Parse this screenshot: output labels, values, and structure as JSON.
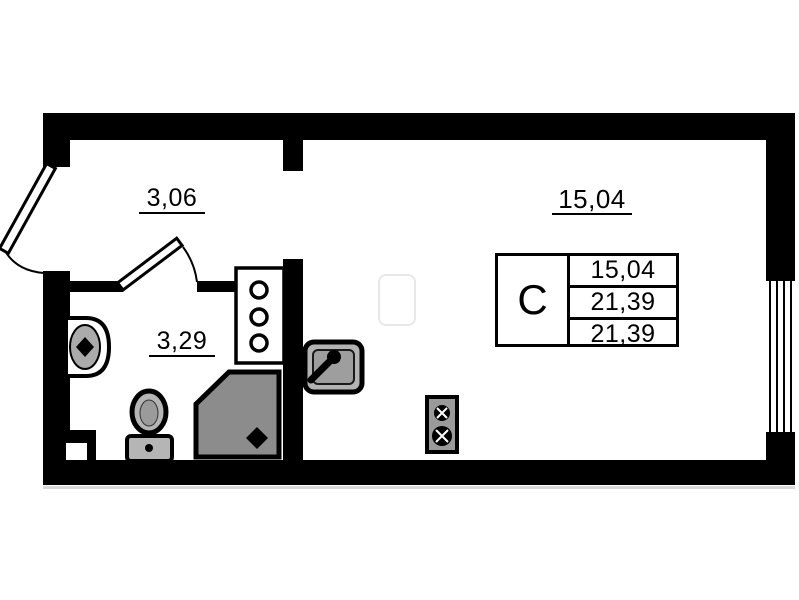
{
  "plan": {
    "rooms": {
      "hall": {
        "label": "3,06"
      },
      "bathroom": {
        "label": "3,29"
      },
      "living": {
        "label": "15,04"
      }
    },
    "info_box": {
      "type": "С",
      "rows": [
        "15,04",
        "21,39",
        "21,39"
      ]
    },
    "colors": {
      "wall": "#000000",
      "background": "#ffffff",
      "shower_gray": "#8c8c8c",
      "fixture_gray": "#b3b3b3",
      "vent_gray": "#9a9a9a"
    },
    "fixtures": [
      "entry-door",
      "bathroom-door",
      "window",
      "bathroom-sink",
      "toilet",
      "shower-tray",
      "kitchen-sink",
      "ventilation-unit",
      "utility-cabinet"
    ]
  }
}
